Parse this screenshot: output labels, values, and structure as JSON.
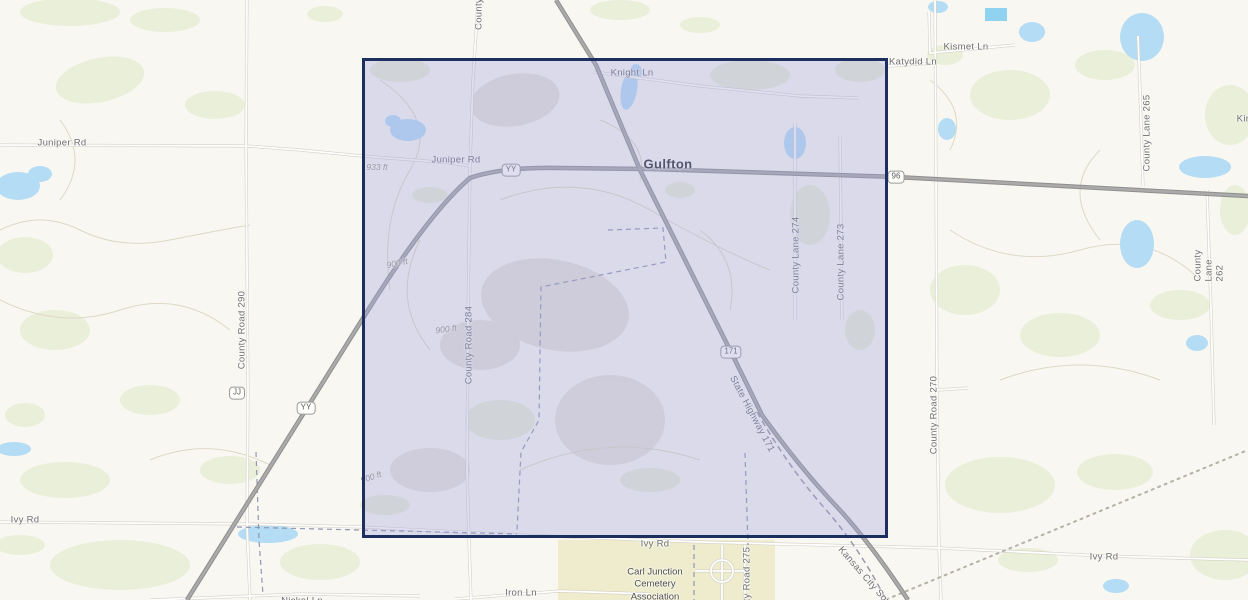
{
  "map": {
    "place_labels": [
      {
        "text": "Gulfton",
        "x": 668,
        "y": 164
      }
    ],
    "road_labels": [
      {
        "text": "Juniper Rd",
        "x": 62,
        "y": 143
      },
      {
        "text": "Juniper Rd",
        "x": 456,
        "y": 160
      },
      {
        "text": "Knight Ln",
        "x": 632,
        "y": 73
      },
      {
        "text": "Kismet Ln",
        "x": 966,
        "y": 47
      },
      {
        "text": "Katydid Ln",
        "x": 913,
        "y": 62
      },
      {
        "text": "Kin",
        "x": 1244,
        "y": 119
      },
      {
        "text": "County",
        "x": 479,
        "y": 14,
        "rot": -90
      },
      {
        "text": "County Lane 265",
        "x": 1147,
        "y": 133,
        "rot": -90
      },
      {
        "text": "County Lane 262",
        "x": 1209,
        "y": 262,
        "rot": -90
      },
      {
        "text": "County Road 290",
        "x": 242,
        "y": 330,
        "rot": -90
      },
      {
        "text": "County Road 284",
        "x": 469,
        "y": 345,
        "rot": -90
      },
      {
        "text": "County Lane 274",
        "x": 796,
        "y": 255,
        "rot": -90
      },
      {
        "text": "County Lane 273",
        "x": 841,
        "y": 262,
        "rot": -90
      },
      {
        "text": "County Road 270",
        "x": 934,
        "y": 415,
        "rot": -90
      },
      {
        "text": "County Road 275",
        "x": 747,
        "y": 586,
        "rot": -90
      },
      {
        "text": "State Highway 171",
        "x": 752,
        "y": 414,
        "rot": 62
      },
      {
        "text": "Kansas City Southern",
        "x": 872,
        "y": 585,
        "rot": 49
      },
      {
        "text": "Ivy Rd",
        "x": 25,
        "y": 520
      },
      {
        "text": "Ivy Rd",
        "x": 655,
        "y": 544
      },
      {
        "text": "Ivy Rd",
        "x": 1104,
        "y": 557
      },
      {
        "text": "Iron Ln",
        "x": 521,
        "y": 593
      },
      {
        "text": "Nickel Ln",
        "x": 302,
        "y": 601
      }
    ],
    "route_markers": [
      {
        "text": "YY",
        "x": 511,
        "y": 170
      },
      {
        "text": "YY",
        "x": 306,
        "y": 408
      },
      {
        "text": "JJ",
        "x": 237,
        "y": 393
      },
      {
        "text": "96",
        "x": 896,
        "y": 177
      },
      {
        "text": "171",
        "x": 731,
        "y": 352
      }
    ],
    "elevation_labels": [
      {
        "text": "933 ft",
        "x": 377,
        "y": 167
      },
      {
        "text": "900 ft",
        "x": 397,
        "y": 263,
        "rot": -12
      },
      {
        "text": "900 ft",
        "x": 446,
        "y": 329,
        "rot": -8
      },
      {
        "text": "900 ft",
        "x": 371,
        "y": 477,
        "rot": -18
      }
    ],
    "poi_labels": [
      {
        "text": "Carl Junction\nCemetery\nAssociation",
        "x": 655,
        "y": 585
      }
    ],
    "selection": {
      "x": 362,
      "y": 58,
      "width": 526,
      "height": 480
    },
    "colors": {
      "selection_fill": "rgba(160,162,219,0.34)",
      "selection_border": "#1d2f5e",
      "water": "#b4dcf4",
      "vegetation": "#e9efd8",
      "terrain_shade": "#e2dfd4",
      "major_road": "#9e9e9e",
      "background": "#f8f7f2"
    }
  }
}
